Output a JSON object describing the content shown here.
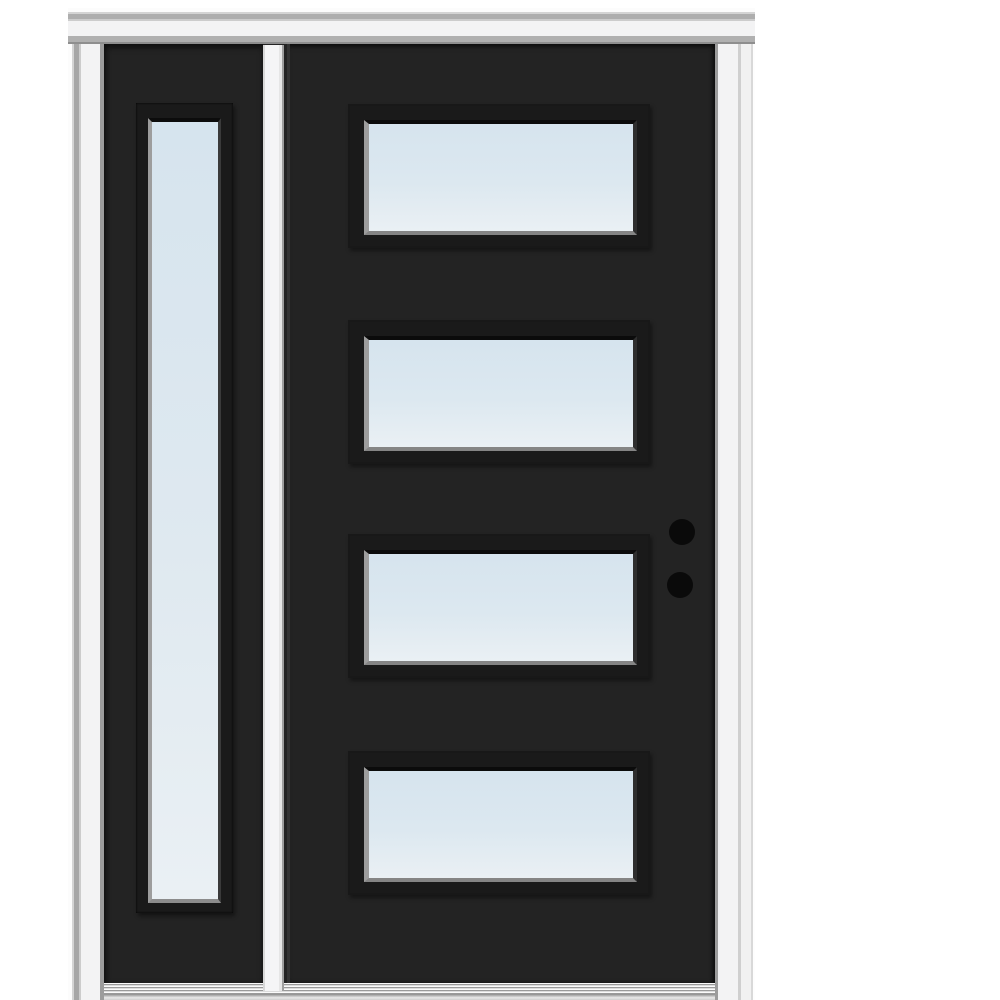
{
  "image": {
    "alt": "Prehung black exterior front door with a left sidelite, four horizontal clear-glass lites in the door slab, one full-length clear-glass lite in the sidelite, white frame and brickmould, two black hardware bore holes, and a ribbed aluminum sill"
  },
  "door": {
    "slab_lite_count": 4,
    "sidelite_position": "left",
    "sidelite_lite_count": 1,
    "bore_hole_count": 2
  },
  "colors": {
    "page_bg": "#ffffff",
    "door_slab": "#232323",
    "lite_bezel": "#1a1a1a",
    "glass_top": "#d6e4ee",
    "glass_bottom": "#eaf0f4",
    "bevel_light": "#9d9d9d",
    "frame_white": "#f3f3f4",
    "frame_stop": "#9c9c9c",
    "mull_white": "#f5f5f6",
    "sill_dark": "#9a9a9a",
    "sill_light": "#e8e8e8",
    "bore_hole": "#0a0a0a"
  }
}
